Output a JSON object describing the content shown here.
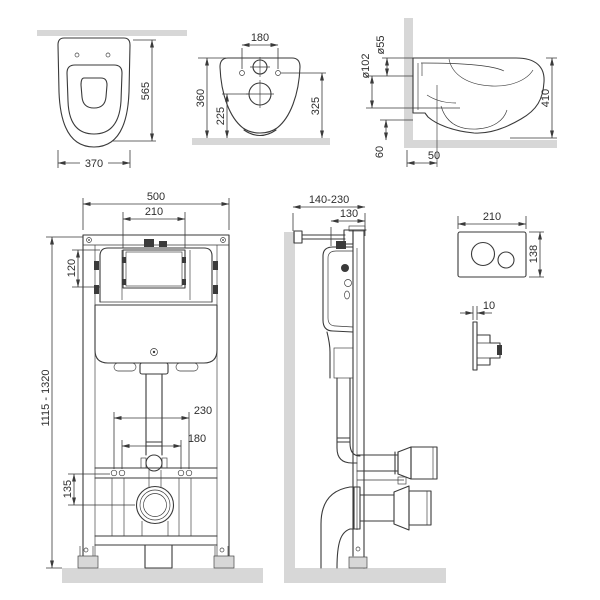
{
  "drawing": {
    "colors": {
      "line": "#3a3a3a",
      "band": "#d7d7d7",
      "bg": "#ffffff"
    },
    "views": {
      "top_view": {
        "dim_depth": "565",
        "dim_width": "370"
      },
      "rear_view": {
        "dim_holes": "180",
        "dim_height": "360",
        "dim_trap_floor": "225",
        "dim_holes_floor": "325"
      },
      "side_view": {
        "dim_inlet": "ø55",
        "dim_outlet": "ø102",
        "dim_height": "410",
        "dim_clearance": "60",
        "dim_offset": "50"
      },
      "frame_front": {
        "dim_width": "500",
        "dim_window": "210",
        "dim_window_h": "120",
        "dim_height_range": "1115 - 1320",
        "dim_studs_outer": "230",
        "dim_studs_inner": "180",
        "dim_outlet_height": "135"
      },
      "frame_side": {
        "dim_wall_range": "140-230",
        "dim_depth": "130"
      },
      "plate_front": {
        "dim_width": "210",
        "dim_height": "138"
      },
      "plate_side": {
        "dim_thickness": "10"
      }
    }
  }
}
